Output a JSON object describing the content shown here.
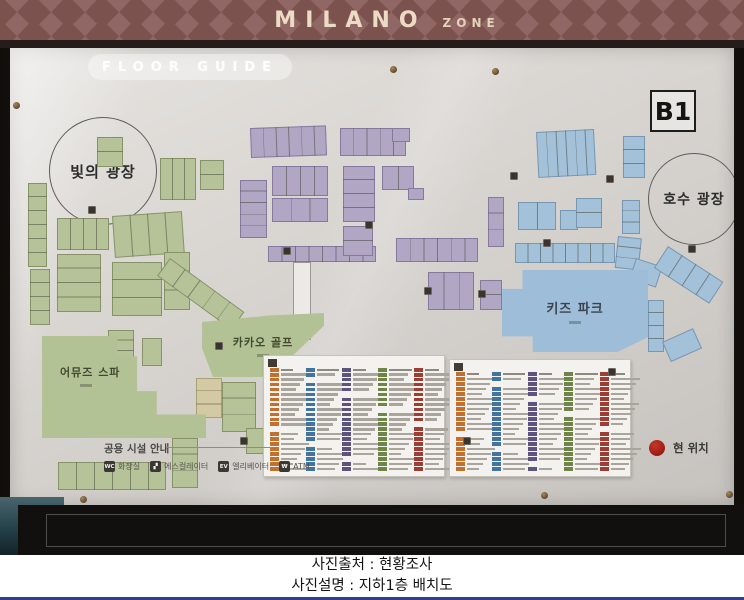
{
  "banner": {
    "title": "MILANO",
    "subtitle": "ZONE",
    "bg": "#906764",
    "diamond": "#7c524f",
    "text_color": "#ecdcc6"
  },
  "board": {
    "header": "FLOOR GUIDE",
    "floor_badge": "B1",
    "plaza_light": "빛의 광장",
    "plaza_lake": "호수 광장",
    "kids_park": "키즈 파크",
    "kakao_golf": "카카오 골프",
    "spa": "어뮤즈 스파",
    "current_location": "현 위치",
    "current_location_color": "#a81c12"
  },
  "legend": {
    "title": "공용 시설 안내",
    "items": [
      {
        "name": "toilet-icon",
        "glyph": "WC",
        "label": "화장실"
      },
      {
        "name": "escalator-icon",
        "glyph": "▞",
        "label": "에스컬레이터"
      },
      {
        "name": "elevator-icon",
        "glyph": "EV",
        "label": "엘리베이터"
      },
      {
        "name": "atm-icon",
        "glyph": "₩",
        "label": "ATM"
      }
    ]
  },
  "caption": {
    "line1": "사진출처 : 현황조사",
    "line2": "사진설명 : 지하1층 배치도"
  },
  "map": {
    "block_colors": {
      "g": "#b6c398",
      "p": "#b1a6c4",
      "b": "#a4c1da",
      "t": "#d3caa3"
    },
    "blocks": [
      {
        "x": 87,
        "y": 89,
        "w": 26,
        "h": 30,
        "c": "g",
        "d": "h",
        "n": 2
      },
      {
        "x": 18,
        "y": 135,
        "w": 19,
        "h": 84,
        "c": "g",
        "d": "h",
        "n": 6
      },
      {
        "x": 20,
        "y": 221,
        "w": 20,
        "h": 56,
        "c": "g",
        "d": "h",
        "n": 4
      },
      {
        "x": 47,
        "y": 170,
        "w": 52,
        "h": 32,
        "c": "g",
        "d": "v",
        "n": 4
      },
      {
        "x": 47,
        "y": 206,
        "w": 44,
        "h": 58,
        "c": "g",
        "d": "h",
        "n": 4
      },
      {
        "x": 102,
        "y": 168,
        "w": 70,
        "h": 42,
        "c": "g",
        "d": "v",
        "n": 4,
        "rot": -4
      },
      {
        "x": 102,
        "y": 214,
        "w": 50,
        "h": 54,
        "c": "g",
        "d": "h",
        "n": 3
      },
      {
        "x": 154,
        "y": 204,
        "w": 26,
        "h": 58,
        "c": "g",
        "d": "h",
        "n": 3
      },
      {
        "x": 160,
        "y": 210,
        "w": 92,
        "h": 22,
        "c": "g",
        "d": "v",
        "n": 5,
        "rot": 36
      },
      {
        "x": 150,
        "y": 110,
        "w": 36,
        "h": 42,
        "c": "g",
        "d": "v",
        "n": 3
      },
      {
        "x": 190,
        "y": 112,
        "w": 24,
        "h": 30,
        "c": "g",
        "d": "h",
        "n": 2
      },
      {
        "x": 98,
        "y": 282,
        "w": 26,
        "h": 42,
        "c": "g",
        "d": "h",
        "n": 4
      },
      {
        "x": 132,
        "y": 290,
        "w": 20,
        "h": 28,
        "c": "g"
      },
      {
        "x": 48,
        "y": 414,
        "w": 108,
        "h": 28,
        "c": "g",
        "d": "v",
        "n": 6
      },
      {
        "x": 162,
        "y": 390,
        "w": 26,
        "h": 50,
        "c": "g",
        "d": "h",
        "n": 3
      },
      {
        "x": 212,
        "y": 334,
        "w": 34,
        "h": 50,
        "c": "g",
        "d": "h",
        "n": 3
      },
      {
        "x": 236,
        "y": 380,
        "w": 30,
        "h": 26,
        "c": "g"
      },
      {
        "x": 186,
        "y": 330,
        "w": 26,
        "h": 40,
        "c": "t",
        "d": "h",
        "n": 3
      },
      {
        "x": 240,
        "y": 80,
        "w": 76,
        "h": 30,
        "c": "p",
        "d": "v",
        "n": 6,
        "rot": -2
      },
      {
        "x": 330,
        "y": 80,
        "w": 66,
        "h": 28,
        "c": "p",
        "d": "v",
        "n": 5
      },
      {
        "x": 382,
        "y": 80,
        "w": 18,
        "h": 14,
        "c": "p"
      },
      {
        "x": 230,
        "y": 132,
        "w": 27,
        "h": 58,
        "c": "p",
        "d": "h",
        "n": 5
      },
      {
        "x": 262,
        "y": 118,
        "w": 56,
        "h": 30,
        "c": "p",
        "d": "v",
        "n": 4
      },
      {
        "x": 262,
        "y": 150,
        "w": 56,
        "h": 24,
        "c": "p",
        "d": "v",
        "n": 3
      },
      {
        "x": 258,
        "y": 198,
        "w": 108,
        "h": 16,
        "c": "p",
        "d": "v",
        "n": 8
      },
      {
        "x": 333,
        "y": 118,
        "w": 32,
        "h": 56,
        "c": "p",
        "d": "h",
        "n": 4
      },
      {
        "x": 333,
        "y": 178,
        "w": 30,
        "h": 30,
        "c": "p",
        "d": "h",
        "n": 2
      },
      {
        "x": 372,
        "y": 118,
        "w": 32,
        "h": 24,
        "c": "p",
        "d": "v",
        "n": 2
      },
      {
        "x": 398,
        "y": 140,
        "w": 16,
        "h": 12,
        "c": "p"
      },
      {
        "x": 386,
        "y": 190,
        "w": 82,
        "h": 24,
        "c": "p",
        "d": "v",
        "n": 6
      },
      {
        "x": 470,
        "y": 232,
        "w": 22,
        "h": 30,
        "c": "p",
        "d": "h",
        "n": 2
      },
      {
        "x": 418,
        "y": 224,
        "w": 46,
        "h": 38,
        "c": "p",
        "d": "v",
        "n": 3
      },
      {
        "x": 478,
        "y": 149,
        "w": 16,
        "h": 50,
        "c": "p",
        "d": "h",
        "n": 3
      },
      {
        "x": 526,
        "y": 84,
        "w": 58,
        "h": 46,
        "c": "b",
        "d": "v",
        "n": 6,
        "rot": -3
      },
      {
        "x": 613,
        "y": 88,
        "w": 22,
        "h": 42,
        "c": "b",
        "d": "h",
        "n": 3
      },
      {
        "x": 508,
        "y": 154,
        "w": 38,
        "h": 28,
        "c": "b",
        "d": "v",
        "n": 2
      },
      {
        "x": 550,
        "y": 162,
        "w": 18,
        "h": 20,
        "c": "b"
      },
      {
        "x": 566,
        "y": 150,
        "w": 26,
        "h": 30,
        "c": "b",
        "d": "h",
        "n": 2
      },
      {
        "x": 612,
        "y": 152,
        "w": 18,
        "h": 34,
        "c": "b",
        "d": "h",
        "n": 3
      },
      {
        "x": 608,
        "y": 188,
        "w": 24,
        "h": 32,
        "c": "b",
        "d": "h",
        "n": 3,
        "rot": 6
      },
      {
        "x": 505,
        "y": 195,
        "w": 100,
        "h": 20,
        "c": "b",
        "d": "v",
        "n": 8
      },
      {
        "x": 626,
        "y": 210,
        "w": 28,
        "h": 22,
        "c": "b",
        "rot": 18
      },
      {
        "x": 658,
        "y": 198,
        "w": 66,
        "h": 26,
        "c": "b",
        "d": "v",
        "n": 4,
        "rot": 33
      },
      {
        "x": 638,
        "y": 252,
        "w": 16,
        "h": 52,
        "c": "b",
        "d": "h",
        "n": 4
      },
      {
        "x": 652,
        "y": 294,
        "w": 34,
        "h": 22,
        "c": "b",
        "rot": -24
      }
    ],
    "facility_icons": [
      {
        "x": 78,
        "y": 158
      },
      {
        "x": 273,
        "y": 199
      },
      {
        "x": 355,
        "y": 173
      },
      {
        "x": 414,
        "y": 239
      },
      {
        "x": 468,
        "y": 242
      },
      {
        "x": 533,
        "y": 191
      },
      {
        "x": 205,
        "y": 294
      },
      {
        "x": 230,
        "y": 389
      },
      {
        "x": 453,
        "y": 389
      },
      {
        "x": 678,
        "y": 197
      },
      {
        "x": 598,
        "y": 320
      },
      {
        "x": 500,
        "y": 124
      },
      {
        "x": 596,
        "y": 127
      }
    ],
    "screws": [
      {
        "x": 3,
        "y": 54
      },
      {
        "x": 380,
        "y": 18
      },
      {
        "x": 482,
        "y": 20
      },
      {
        "x": 70,
        "y": 448
      },
      {
        "x": 531,
        "y": 444
      },
      {
        "x": 716,
        "y": 443
      }
    ]
  },
  "panels": {
    "chip_colors": [
      "#c1702e",
      "#43749f",
      "#5d537f",
      "#6f8447",
      "#9d3d33"
    ],
    "left": {
      "x": 253,
      "y": 307,
      "w": 182,
      "h": 122,
      "rows": 21,
      "col_x": [
        6,
        42,
        78,
        114,
        150
      ]
    },
    "right": {
      "x": 439,
      "y": 311,
      "w": 182,
      "h": 118,
      "rows": 20,
      "col_x": [
        6,
        42,
        78,
        114,
        150
      ]
    }
  }
}
